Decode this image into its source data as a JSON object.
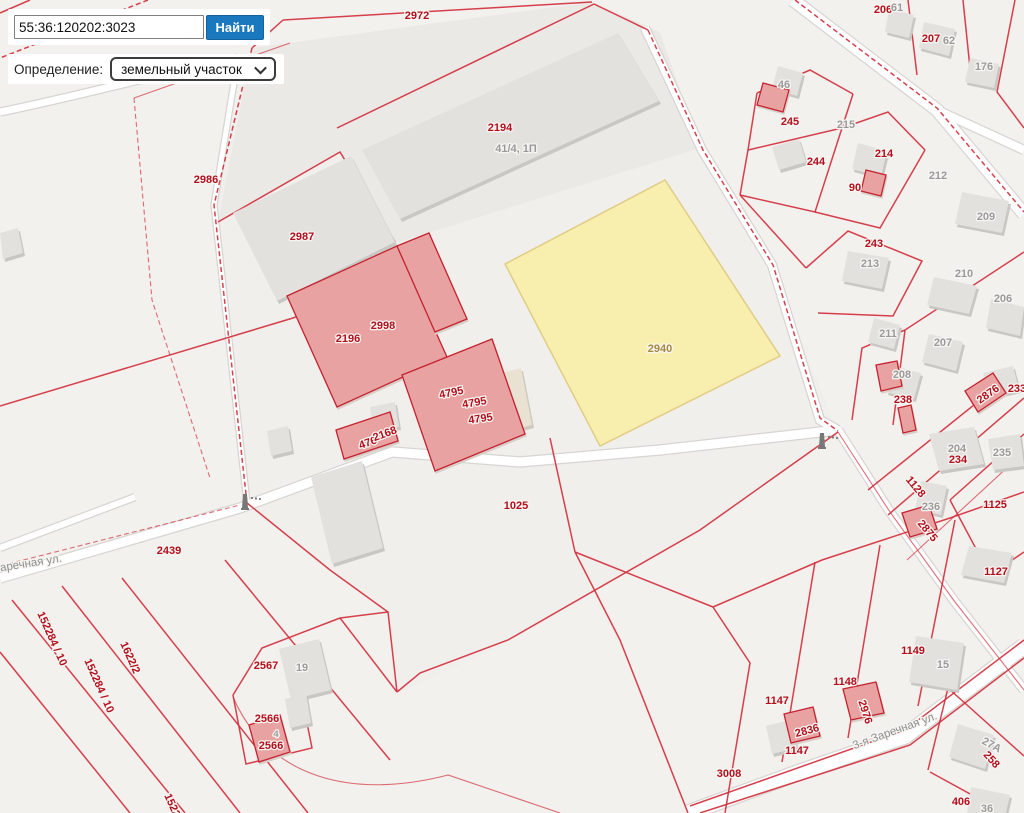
{
  "search": {
    "query": "55:36:120202:3023",
    "button_label": "Найти"
  },
  "filter": {
    "label": "Определение:",
    "selected_option": "земельный участок"
  },
  "map": {
    "highlight_parcel": {
      "number": "2940",
      "fill": "#f8efae"
    },
    "labels": [
      {
        "t": "2972",
        "x": 417,
        "y": 19,
        "c": "r"
      },
      {
        "t": "2194",
        "x": 500,
        "y": 131,
        "c": "r"
      },
      {
        "t": "41/4, 1П",
        "x": 516,
        "y": 152,
        "c": "g"
      },
      {
        "t": "2986",
        "x": 206,
        "y": 183,
        "c": "r"
      },
      {
        "t": "2987",
        "x": 302,
        "y": 240,
        "c": "r"
      },
      {
        "t": "2998",
        "x": 383,
        "y": 329,
        "c": "r"
      },
      {
        "t": "2196",
        "x": 348,
        "y": 342,
        "c": "r"
      },
      {
        "t": "4795",
        "x": 452,
        "y": 396,
        "c": "r",
        "r": -12
      },
      {
        "t": "4795",
        "x": 475,
        "y": 406,
        "c": "r",
        "r": -10
      },
      {
        "t": "4795",
        "x": 481,
        "y": 422,
        "c": "r",
        "r": -8
      },
      {
        "t": "476",
        "x": 369,
        "y": 446,
        "c": "r",
        "r": -20
      },
      {
        "t": "2168",
        "x": 386,
        "y": 437,
        "c": "r",
        "r": -20
      },
      {
        "t": "2940",
        "x": 660,
        "y": 352,
        "c": "b"
      },
      {
        "t": "1025",
        "x": 516,
        "y": 509,
        "c": "r"
      },
      {
        "t": "2439",
        "x": 169,
        "y": 554,
        "c": "r"
      },
      {
        "t": "Заречная ул.",
        "x": 28,
        "y": 567,
        "c": "s",
        "r": -9
      },
      {
        "t": "152284 / 10",
        "x": 49,
        "y": 640,
        "c": "r",
        "r": 66
      },
      {
        "t": "1622/2",
        "x": 127,
        "y": 659,
        "c": "r",
        "r": 66
      },
      {
        "t": "152284 / 10",
        "x": 96,
        "y": 687,
        "c": "r",
        "r": 66
      },
      {
        "t": "152284 / 10",
        "x": 176,
        "y": 822,
        "c": "r",
        "r": 66
      },
      {
        "t": "2567",
        "x": 266,
        "y": 669,
        "c": "r"
      },
      {
        "t": "19",
        "x": 302,
        "y": 671,
        "c": "g"
      },
      {
        "t": "2566",
        "x": 267,
        "y": 722,
        "c": "r"
      },
      {
        "t": "4",
        "x": 276,
        "y": 737,
        "c": "g",
        "sm": 1
      },
      {
        "t": "2566",
        "x": 271,
        "y": 749,
        "c": "r"
      },
      {
        "t": "3008",
        "x": 729,
        "y": 777,
        "c": "r"
      },
      {
        "t": "1147",
        "x": 777,
        "y": 704,
        "c": "r"
      },
      {
        "t": "2836",
        "x": 808,
        "y": 734,
        "c": "r",
        "r": -15
      },
      {
        "t": "1147",
        "x": 797,
        "y": 754,
        "c": "r"
      },
      {
        "t": "1148",
        "x": 845,
        "y": 685,
        "c": "r"
      },
      {
        "t": "2976",
        "x": 862,
        "y": 713,
        "c": "r",
        "r": 72
      },
      {
        "t": "1149",
        "x": 913,
        "y": 654,
        "c": "r"
      },
      {
        "t": "15",
        "x": 943,
        "y": 668,
        "c": "g"
      },
      {
        "t": "3-я Заречная ул.",
        "x": 896,
        "y": 734,
        "c": "s",
        "r": -20
      },
      {
        "t": "406",
        "x": 961,
        "y": 805,
        "c": "r"
      },
      {
        "t": "36",
        "x": 987,
        "y": 812,
        "c": "g"
      },
      {
        "t": "27А",
        "x": 990,
        "y": 748,
        "c": "g",
        "r": 28
      },
      {
        "t": "258",
        "x": 989,
        "y": 762,
        "c": "r",
        "r": 48
      },
      {
        "t": "206",
        "x": 883,
        "y": 13,
        "c": "r"
      },
      {
        "t": "61",
        "x": 897,
        "y": 11,
        "c": "g"
      },
      {
        "t": "207",
        "x": 931,
        "y": 42,
        "c": "r"
      },
      {
        "t": "62",
        "x": 949,
        "y": 44,
        "c": "g"
      },
      {
        "t": "176",
        "x": 984,
        "y": 70,
        "c": "g"
      },
      {
        "t": "46",
        "x": 784,
        "y": 88,
        "c": "g"
      },
      {
        "t": "245",
        "x": 790,
        "y": 125,
        "c": "r"
      },
      {
        "t": "215",
        "x": 846,
        "y": 128,
        "c": "g"
      },
      {
        "t": "244",
        "x": 816,
        "y": 165,
        "c": "r"
      },
      {
        "t": "214",
        "x": 884,
        "y": 157,
        "c": "r"
      },
      {
        "t": "90",
        "x": 855,
        "y": 191,
        "c": "r"
      },
      {
        "t": "212",
        "x": 938,
        "y": 179,
        "c": "g"
      },
      {
        "t": "209",
        "x": 986,
        "y": 220,
        "c": "g"
      },
      {
        "t": "243",
        "x": 874,
        "y": 247,
        "c": "r"
      },
      {
        "t": "213",
        "x": 870,
        "y": 267,
        "c": "g"
      },
      {
        "t": "210",
        "x": 964,
        "y": 277,
        "c": "g"
      },
      {
        "t": "206",
        "x": 1003,
        "y": 302,
        "c": "g"
      },
      {
        "t": "211",
        "x": 888,
        "y": 337,
        "c": "g"
      },
      {
        "t": "207",
        "x": 943,
        "y": 346,
        "c": "g"
      },
      {
        "t": "208",
        "x": 902,
        "y": 378,
        "c": "g"
      },
      {
        "t": "238",
        "x": 903,
        "y": 403,
        "c": "r"
      },
      {
        "t": "2876",
        "x": 990,
        "y": 397,
        "c": "r",
        "r": -35
      },
      {
        "t": "233",
        "x": 1017,
        "y": 392,
        "c": "r"
      },
      {
        "t": "204",
        "x": 957,
        "y": 452,
        "c": "g"
      },
      {
        "t": "234",
        "x": 958,
        "y": 463,
        "c": "r"
      },
      {
        "t": "235",
        "x": 1002,
        "y": 456,
        "c": "g"
      },
      {
        "t": "1128",
        "x": 913,
        "y": 489,
        "c": "r",
        "r": 50
      },
      {
        "t": "236",
        "x": 931,
        "y": 510,
        "c": "g"
      },
      {
        "t": "2875",
        "x": 925,
        "y": 533,
        "c": "r",
        "r": 50
      },
      {
        "t": "1125",
        "x": 995,
        "y": 508,
        "c": "r"
      },
      {
        "t": "1127",
        "x": 996,
        "y": 575,
        "c": "r"
      }
    ]
  },
  "colors": {
    "accent_button": "#1a78be",
    "parcel_line": "#d2303d",
    "label_red": "#b30f1d",
    "label_gray": "#9a9a9a",
    "label_brown": "#a8893d",
    "highlight_fill": "#f8efae",
    "building_fill": "#e2e1de",
    "pink_building": "#e8a2a2"
  }
}
